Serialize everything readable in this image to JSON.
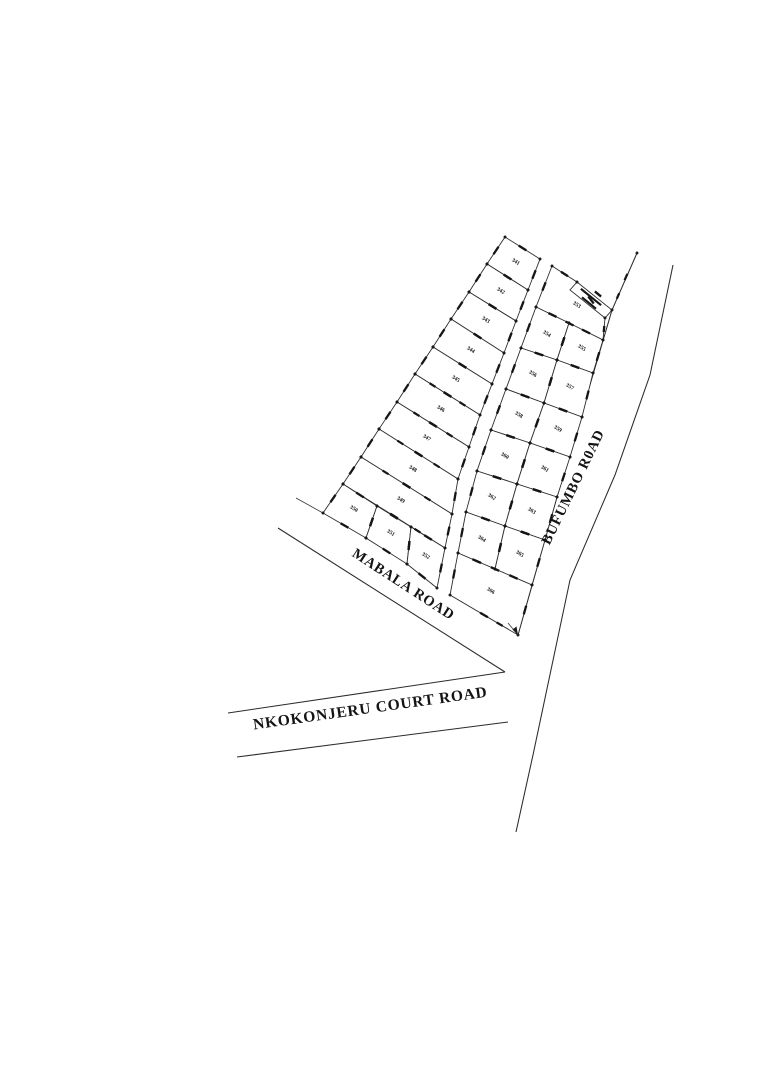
{
  "plan": {
    "type": "cadastral-subdivision-survey-plan",
    "background_color": "#ffffff",
    "line_color": "#2e2e2e",
    "text_color": "#141414"
  },
  "roads": [
    {
      "id": "mabala",
      "name": "MABALA ROAD",
      "label_x": 401,
      "label_y": 588,
      "rotation": 33,
      "font_size": 14.5
    },
    {
      "id": "bufumbo",
      "name": "BUFUMBO R0AD",
      "label_x": 577,
      "label_y": 489,
      "rotation": -64,
      "font_size": 14.5
    },
    {
      "id": "nkokonjeru",
      "name": "NKOKONJERU COURT ROAD",
      "label_x": 371,
      "label_y": 713,
      "rotation": -8,
      "font_size": 15.5
    }
  ],
  "plots": [
    {
      "label": "341",
      "cx": 515,
      "cy": 263,
      "points": [
        [
          505,
          237
        ],
        [
          540,
          259
        ],
        [
          528,
          290
        ],
        [
          487,
          264
        ]
      ]
    },
    {
      "label": "342",
      "cx": 500,
      "cy": 292,
      "points": [
        [
          487,
          264
        ],
        [
          528,
          290
        ],
        [
          516,
          321
        ],
        [
          469,
          292
        ]
      ]
    },
    {
      "label": "343",
      "cx": 485,
      "cy": 321,
      "points": [
        [
          469,
          292
        ],
        [
          516,
          321
        ],
        [
          504,
          353
        ],
        [
          451,
          319
        ]
      ]
    },
    {
      "label": "344",
      "cx": 470,
      "cy": 351,
      "points": [
        [
          451,
          319
        ],
        [
          504,
          353
        ],
        [
          492,
          384
        ],
        [
          433,
          347
        ]
      ]
    },
    {
      "label": "345",
      "cx": 455,
      "cy": 380,
      "points": [
        [
          433,
          347
        ],
        [
          492,
          384
        ],
        [
          480,
          415
        ],
        [
          415,
          374
        ]
      ]
    },
    {
      "label": "346",
      "cx": 440,
      "cy": 410,
      "points": [
        [
          415,
          374
        ],
        [
          480,
          415
        ],
        [
          469,
          447
        ],
        [
          397,
          402
        ]
      ]
    },
    {
      "label": "347",
      "cx": 426,
      "cy": 439,
      "points": [
        [
          397,
          402
        ],
        [
          469,
          447
        ],
        [
          458,
          479
        ],
        [
          379,
          429
        ]
      ]
    },
    {
      "label": "348",
      "cx": 412,
      "cy": 470,
      "points": [
        [
          379,
          429
        ],
        [
          458,
          479
        ],
        [
          452,
          514
        ],
        [
          361,
          457
        ]
      ]
    },
    {
      "label": "349",
      "cx": 400,
      "cy": 501,
      "points": [
        [
          361,
          457
        ],
        [
          452,
          514
        ],
        [
          445,
          548
        ],
        [
          343,
          484
        ]
      ]
    },
    {
      "label": "350",
      "cx": 353,
      "cy": 510,
      "points": [
        [
          343,
          484
        ],
        [
          377,
          506
        ],
        [
          366,
          538
        ],
        [
          323,
          513
        ]
      ]
    },
    {
      "label": "351",
      "cx": 390,
      "cy": 534,
      "points": [
        [
          377,
          506
        ],
        [
          411,
          527
        ],
        [
          407,
          564
        ],
        [
          366,
          538
        ]
      ]
    },
    {
      "label": "352",
      "cx": 425,
      "cy": 557,
      "points": [
        [
          411,
          527
        ],
        [
          445,
          548
        ],
        [
          437,
          588
        ],
        [
          407,
          564
        ]
      ]
    },
    {
      "label": "353",
      "cx": 576,
      "cy": 306,
      "points": [
        [
          552,
          266
        ],
        [
          577,
          282
        ],
        [
          605,
          318
        ],
        [
          603,
          340
        ],
        [
          536,
          307
        ]
      ]
    },
    {
      "label": "354",
      "cx": 546,
      "cy": 335,
      "points": [
        [
          536,
          307
        ],
        [
          569,
          323
        ],
        [
          557,
          360
        ],
        [
          521,
          348
        ]
      ]
    },
    {
      "label": "355",
      "cx": 581,
      "cy": 349,
      "points": [
        [
          569,
          323
        ],
        [
          603,
          340
        ],
        [
          593,
          373
        ],
        [
          557,
          360
        ]
      ]
    },
    {
      "label": "356",
      "cx": 532,
      "cy": 375,
      "points": [
        [
          521,
          348
        ],
        [
          557,
          360
        ],
        [
          544,
          403
        ],
        [
          506,
          389
        ]
      ]
    },
    {
      "label": "357",
      "cx": 569,
      "cy": 388,
      "points": [
        [
          557,
          360
        ],
        [
          593,
          373
        ],
        [
          582,
          417
        ],
        [
          544,
          403
        ]
      ]
    },
    {
      "label": "358",
      "cx": 518,
      "cy": 416,
      "points": [
        [
          506,
          389
        ],
        [
          544,
          403
        ],
        [
          530,
          443
        ],
        [
          491,
          430
        ]
      ]
    },
    {
      "label": "359",
      "cx": 557,
      "cy": 430,
      "points": [
        [
          544,
          403
        ],
        [
          582,
          417
        ],
        [
          570,
          457
        ],
        [
          530,
          443
        ]
      ]
    },
    {
      "label": "360",
      "cx": 504,
      "cy": 457,
      "points": [
        [
          491,
          430
        ],
        [
          530,
          443
        ],
        [
          517,
          484
        ],
        [
          477,
          471
        ]
      ]
    },
    {
      "label": "361",
      "cx": 544,
      "cy": 470,
      "points": [
        [
          530,
          443
        ],
        [
          570,
          457
        ],
        [
          557,
          497
        ],
        [
          517,
          484
        ]
      ]
    },
    {
      "label": "362",
      "cx": 491,
      "cy": 498,
      "points": [
        [
          477,
          471
        ],
        [
          517,
          484
        ],
        [
          505,
          526
        ],
        [
          466,
          512
        ]
      ]
    },
    {
      "label": "363",
      "cx": 531,
      "cy": 512,
      "points": [
        [
          517,
          484
        ],
        [
          557,
          497
        ],
        [
          545,
          540
        ],
        [
          505,
          526
        ]
      ]
    },
    {
      "label": "364",
      "cx": 481,
      "cy": 540,
      "points": [
        [
          466,
          512
        ],
        [
          505,
          526
        ],
        [
          495,
          569
        ],
        [
          458,
          553
        ]
      ]
    },
    {
      "label": "365",
      "cx": 519,
      "cy": 555,
      "points": [
        [
          505,
          526
        ],
        [
          545,
          540
        ],
        [
          532,
          585
        ],
        [
          495,
          569
        ]
      ]
    },
    {
      "label": "366",
      "cx": 490,
      "cy": 592,
      "points": [
        [
          458,
          553
        ],
        [
          532,
          585
        ],
        [
          518,
          635
        ],
        [
          450,
          595
        ]
      ]
    }
  ],
  "reserve_strip": {
    "points": [
      [
        577,
        282
      ],
      [
        612,
        310
      ],
      [
        605,
        318
      ],
      [
        570,
        290
      ]
    ]
  }
}
